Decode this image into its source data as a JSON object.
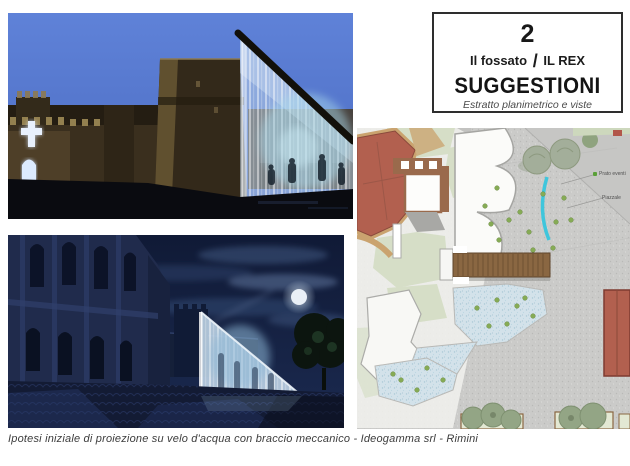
{
  "header_card": {
    "number": "2",
    "location": "Il fossato",
    "separator": "/",
    "venue": "IL REX",
    "title": "SUGGESTIONI",
    "subtitle": "Estratto planimetrico e viste"
  },
  "site_plan": {
    "labels": [
      {
        "text": "Prato eventi",
        "marker_color": "#5aa038"
      },
      {
        "text": "Piazzale"
      }
    ],
    "colors": {
      "water_arc": "#3fc6dc",
      "roof": "#b2604f",
      "pavement": "#cbcbc9",
      "grass": "#d5dec6",
      "bridge": "#8a6742"
    }
  },
  "caption": "Ipotesi iniziale di proiezione su velo d'acqua con braccio meccanico - Ideogamma srl - Rimini"
}
